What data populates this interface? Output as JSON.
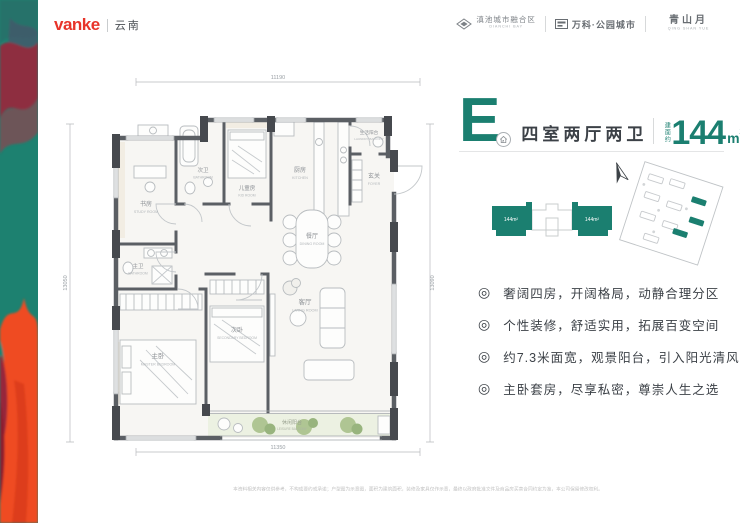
{
  "brand": {
    "logo_text": "vanke",
    "region": "云南"
  },
  "header": {
    "area": {
      "title": "滇池城市融合区",
      "subtitle": "DIANCHI BAY"
    },
    "project": {
      "title": "万科·公园城市"
    },
    "product": {
      "title": "青山月",
      "subtitle": "QING SHAN YUE"
    }
  },
  "unit": {
    "letter": "E",
    "layout": "四室两厅两卫",
    "area_label": "建面约",
    "area_value": "144",
    "area_unit": "m",
    "area_sup": "2"
  },
  "keyplan": {
    "left_label": "144m²",
    "right_label": "144m²"
  },
  "ui": {
    "bullet": "◎"
  },
  "features": [
    "奢阔四房，开阔格局，动静合理分区",
    "个性装修，舒适实用，拓展百变空间",
    "约7.3米面宽，观景阳台，引入阳光清风",
    "主卧套房，尽享私密，尊崇人生之选"
  ],
  "floorplan": {
    "dimensions": {
      "top": "11190",
      "bottom": "11350",
      "left": "13050",
      "right": "13090"
    },
    "rooms": {
      "study": {
        "zh": "书房",
        "en": "STUDY ROOM"
      },
      "master_bath": {
        "zh": "主卫",
        "en": "BATHROOM"
      },
      "master_bed": {
        "zh": "主卧",
        "en": "MASTER BEDROOM"
      },
      "second_bath": {
        "zh": "次卫",
        "en": "BATHROOM"
      },
      "kid": {
        "zh": "儿童房",
        "en": "KID ROOM"
      },
      "kitchen": {
        "zh": "厨房",
        "en": "KITCHEN"
      },
      "laundry": {
        "zh": "生活阳台",
        "en": "LAUNDRY BALCONY"
      },
      "foyer": {
        "zh": "玄关",
        "en": "FOYER"
      },
      "dining": {
        "zh": "餐厅",
        "en": "DINING ROOM"
      },
      "living": {
        "zh": "客厅",
        "en": "LIVING ROOM"
      },
      "second_bed": {
        "zh": "次卧",
        "en": "SECONDARY BEDROOM"
      },
      "leisure": {
        "zh": "休闲阳台",
        "en": "LEISURE BALCONY"
      }
    }
  },
  "disclaimer": "本资料相关内容仅供参考，不构成要约或承诺；户型图为示意图，面积为建筑面积，装修及家具仅作示意，最终以政府批准文件及商品房买卖合同约定为准，本公司保留修改权利。",
  "colors": {
    "accent": "#1b7f70",
    "brand_red": "#e8342a"
  }
}
